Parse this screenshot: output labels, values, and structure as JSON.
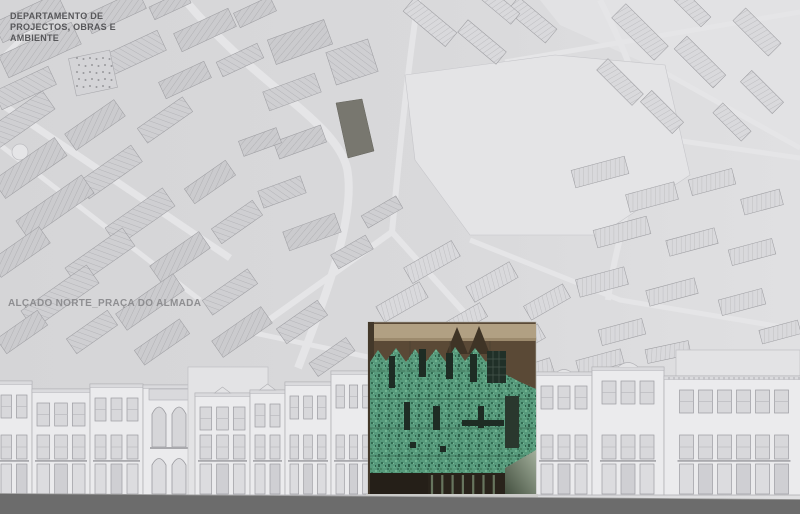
{
  "labels": {
    "department": [
      "DEPARTAMENTO DE",
      "PROJECTOS, OBRAS E",
      "AMBIENTE"
    ],
    "drawing_title": "ALÇADO NORTE_PRAÇA DO ALMADA"
  },
  "colors": {
    "map_background": "#d7d7d9",
    "map_background_right": "#dfdfe1",
    "map_block": "#cdcdd0",
    "map_road": "#e5e5e7",
    "site_parcel_dark": "#78776f",
    "facade_light": "#ebebed",
    "facade_back": "#e3e3e5",
    "window_gray": "#d8d8db",
    "ground_band": "#6c6c6c",
    "building_tan_band": "#b1a083",
    "building_brown_backdrop": "#5a4936",
    "building_gable_silhouette": "#3f3426",
    "green_facade": "#579a7c",
    "green_speckle_dark": "#346e54",
    "green_speckle_light": "#6fb28f",
    "storefront_dark": "#29231b",
    "storefront_mullion": "#67755e",
    "ramp_light": "#a3b09c",
    "ramp_dark": "#414d3d"
  }
}
